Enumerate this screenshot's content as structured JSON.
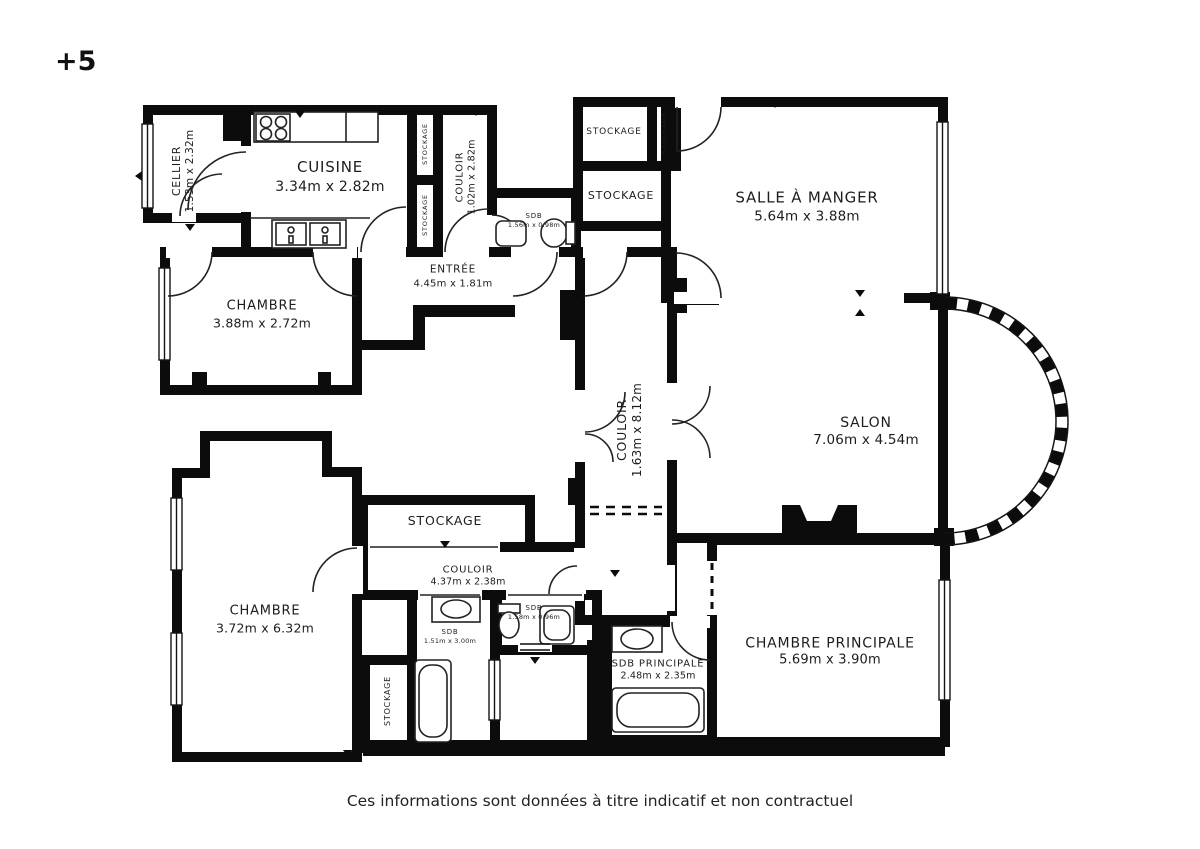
{
  "floor_label": "+5",
  "caption": "Ces informations sont données à titre indicatif et non contractuel",
  "colors": {
    "wall": "#0c0c0c",
    "line": "#222222",
    "background": "#ffffff",
    "text": "#1d1d1d"
  },
  "rooms": [
    {
      "id": "cellier",
      "name": "CELLIER",
      "dims": "1.53m x 2.32m"
    },
    {
      "id": "cuisine",
      "name": "CUISINE",
      "dims": "3.34m x 2.82m"
    },
    {
      "id": "stockage-closet-1",
      "name": "STOCKAGE"
    },
    {
      "id": "stockage-closet-2",
      "name": "STOCKAGE"
    },
    {
      "id": "couloir-haut",
      "name": "COULOIR",
      "dims": "1.02m x 2.82m"
    },
    {
      "id": "sdb-haut",
      "name": "SDB",
      "dims": "1.56m x 0.98m"
    },
    {
      "id": "stockage-1",
      "name": "STOCKAGE"
    },
    {
      "id": "stockage-vertical",
      "name": "STOCKAGE"
    },
    {
      "id": "stockage-2",
      "name": "STOCKAGE"
    },
    {
      "id": "salle-a-manger",
      "name": "SALLE À MANGER",
      "dims": "5.64m x 3.88m"
    },
    {
      "id": "entree",
      "name": "ENTRÉE",
      "dims": "4.45m x 1.81m"
    },
    {
      "id": "chambre-haut",
      "name": "CHAMBRE",
      "dims": "3.88m x 2.72m"
    },
    {
      "id": "couloir-central",
      "name": "COULOIR",
      "dims": "1.63m x 8.12m"
    },
    {
      "id": "salon",
      "name": "SALON",
      "dims": "7.06m x 4.54m"
    },
    {
      "id": "chambre-bas",
      "name": "CHAMBRE",
      "dims": "3.72m x 6.32m"
    },
    {
      "id": "stockage-milieu",
      "name": "STOCKAGE"
    },
    {
      "id": "couloir-bas",
      "name": "COULOIR",
      "dims": "4.37m x 2.38m"
    },
    {
      "id": "sdb-bas",
      "name": "SDB",
      "dims": "1.51m x 3.00m"
    },
    {
      "id": "sdb-petit",
      "name": "SDB",
      "dims": "1.58m x 0.96m"
    },
    {
      "id": "stockage-bas",
      "name": "STOCKAGE"
    },
    {
      "id": "sdb-principale",
      "name": "SDB PRINCIPALE",
      "dims": "2.48m x 2.35m"
    },
    {
      "id": "chambre-principale",
      "name": "CHAMBRE PRINCIPALE",
      "dims": "5.69m x 3.90m"
    }
  ]
}
